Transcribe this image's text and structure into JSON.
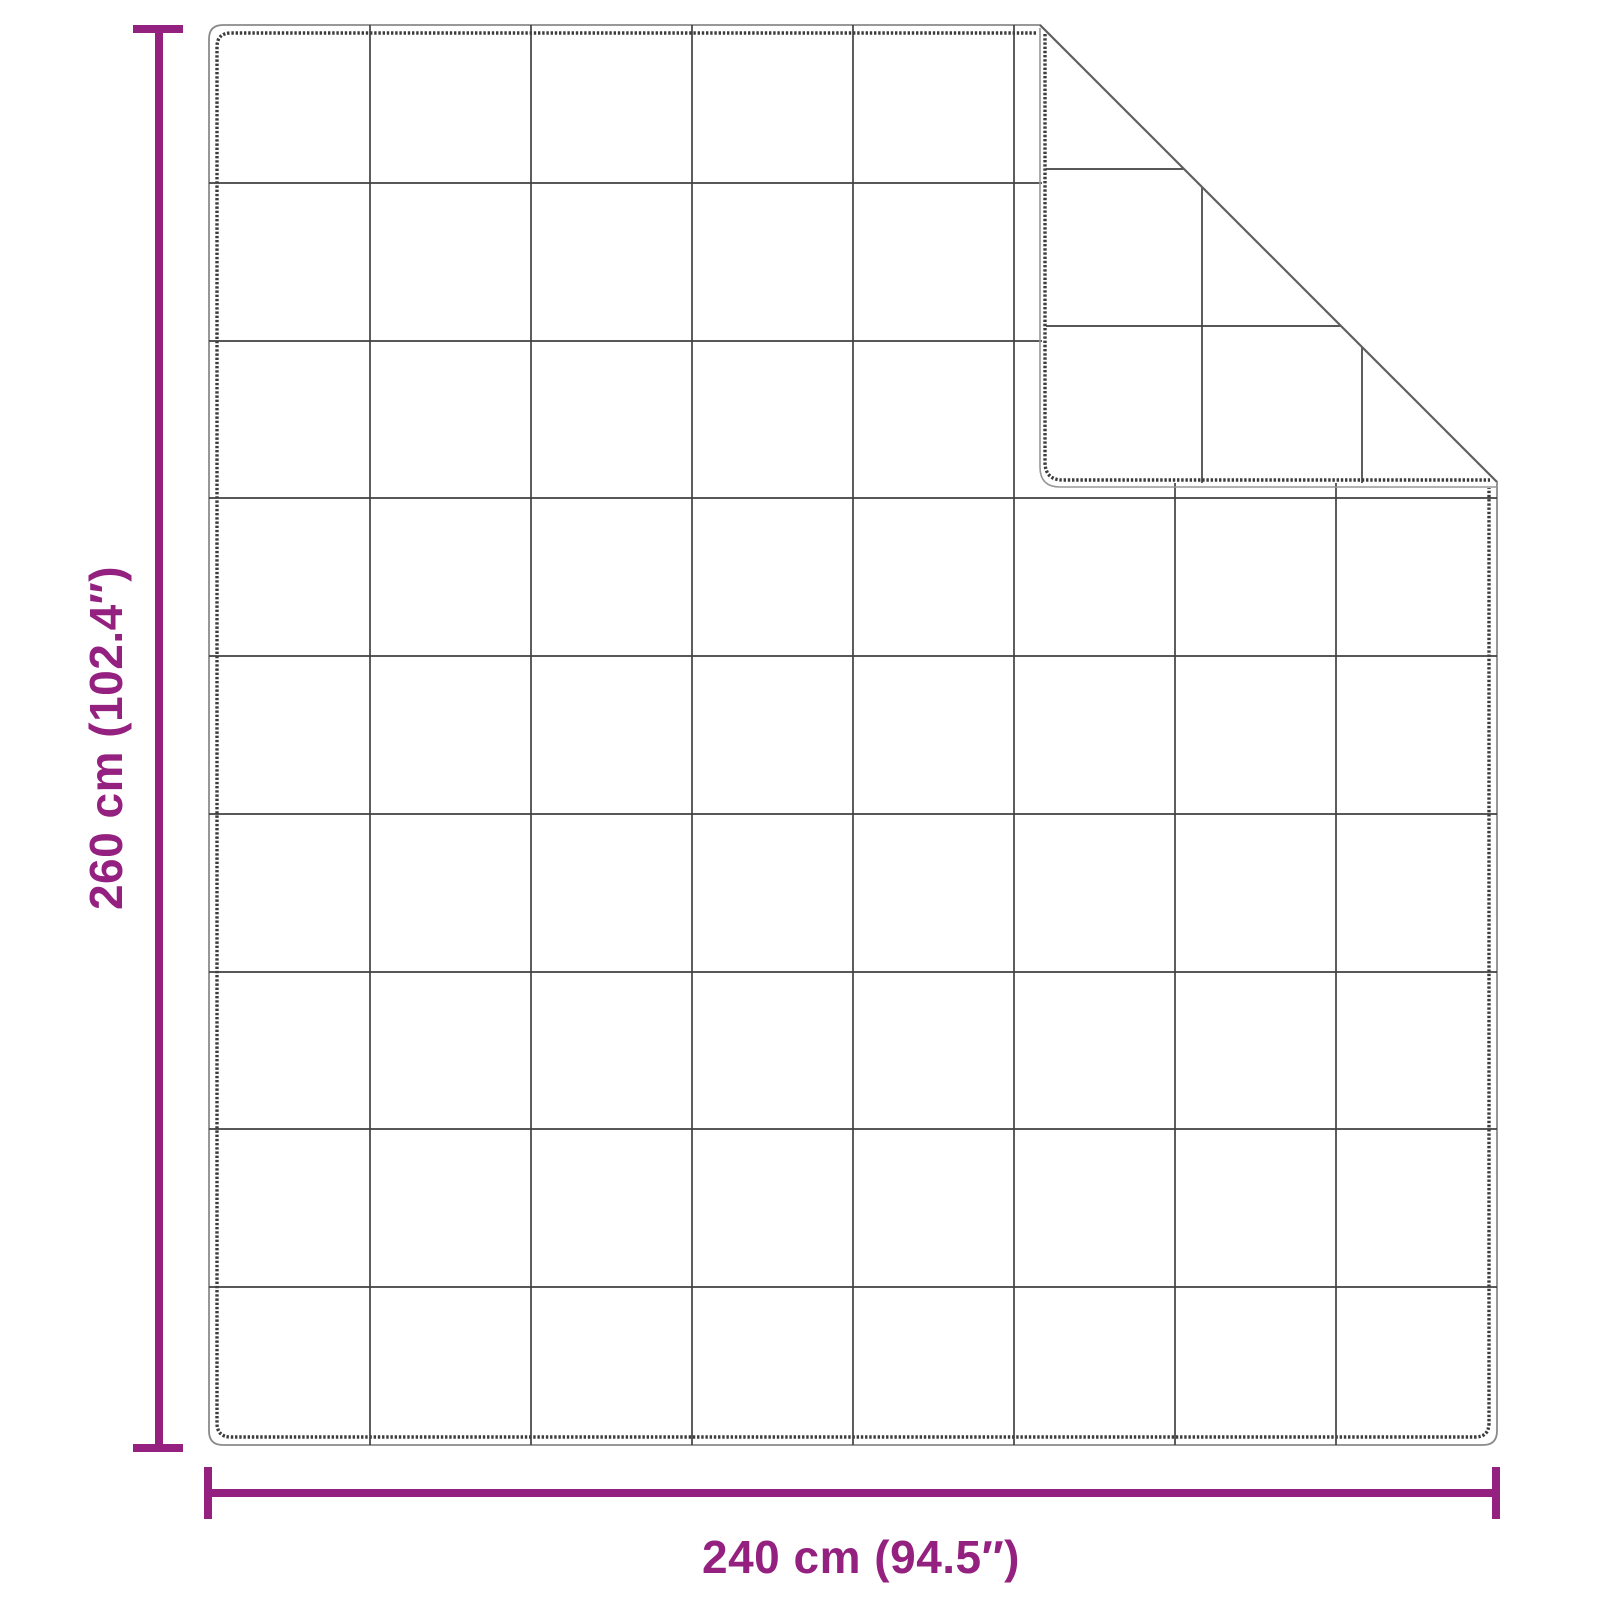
{
  "diagram": {
    "type": "product-dimensions",
    "subject": "quilted blanket with folded top-right corner",
    "height_label": "260 cm (102.4″)",
    "width_label": "240 cm (94.5″)",
    "dimensions": {
      "height_cm": 260,
      "height_inches": 102.4,
      "width_cm": 240,
      "width_inches": 94.5
    },
    "quilt_grid": {
      "columns": 8,
      "rows": 9
    },
    "colors": {
      "dimension_accent": "#94207f",
      "outline": "#8a8a8a",
      "stitching": "#3c3c3c",
      "grid_line": "#414141",
      "background": "#ffffff"
    }
  }
}
